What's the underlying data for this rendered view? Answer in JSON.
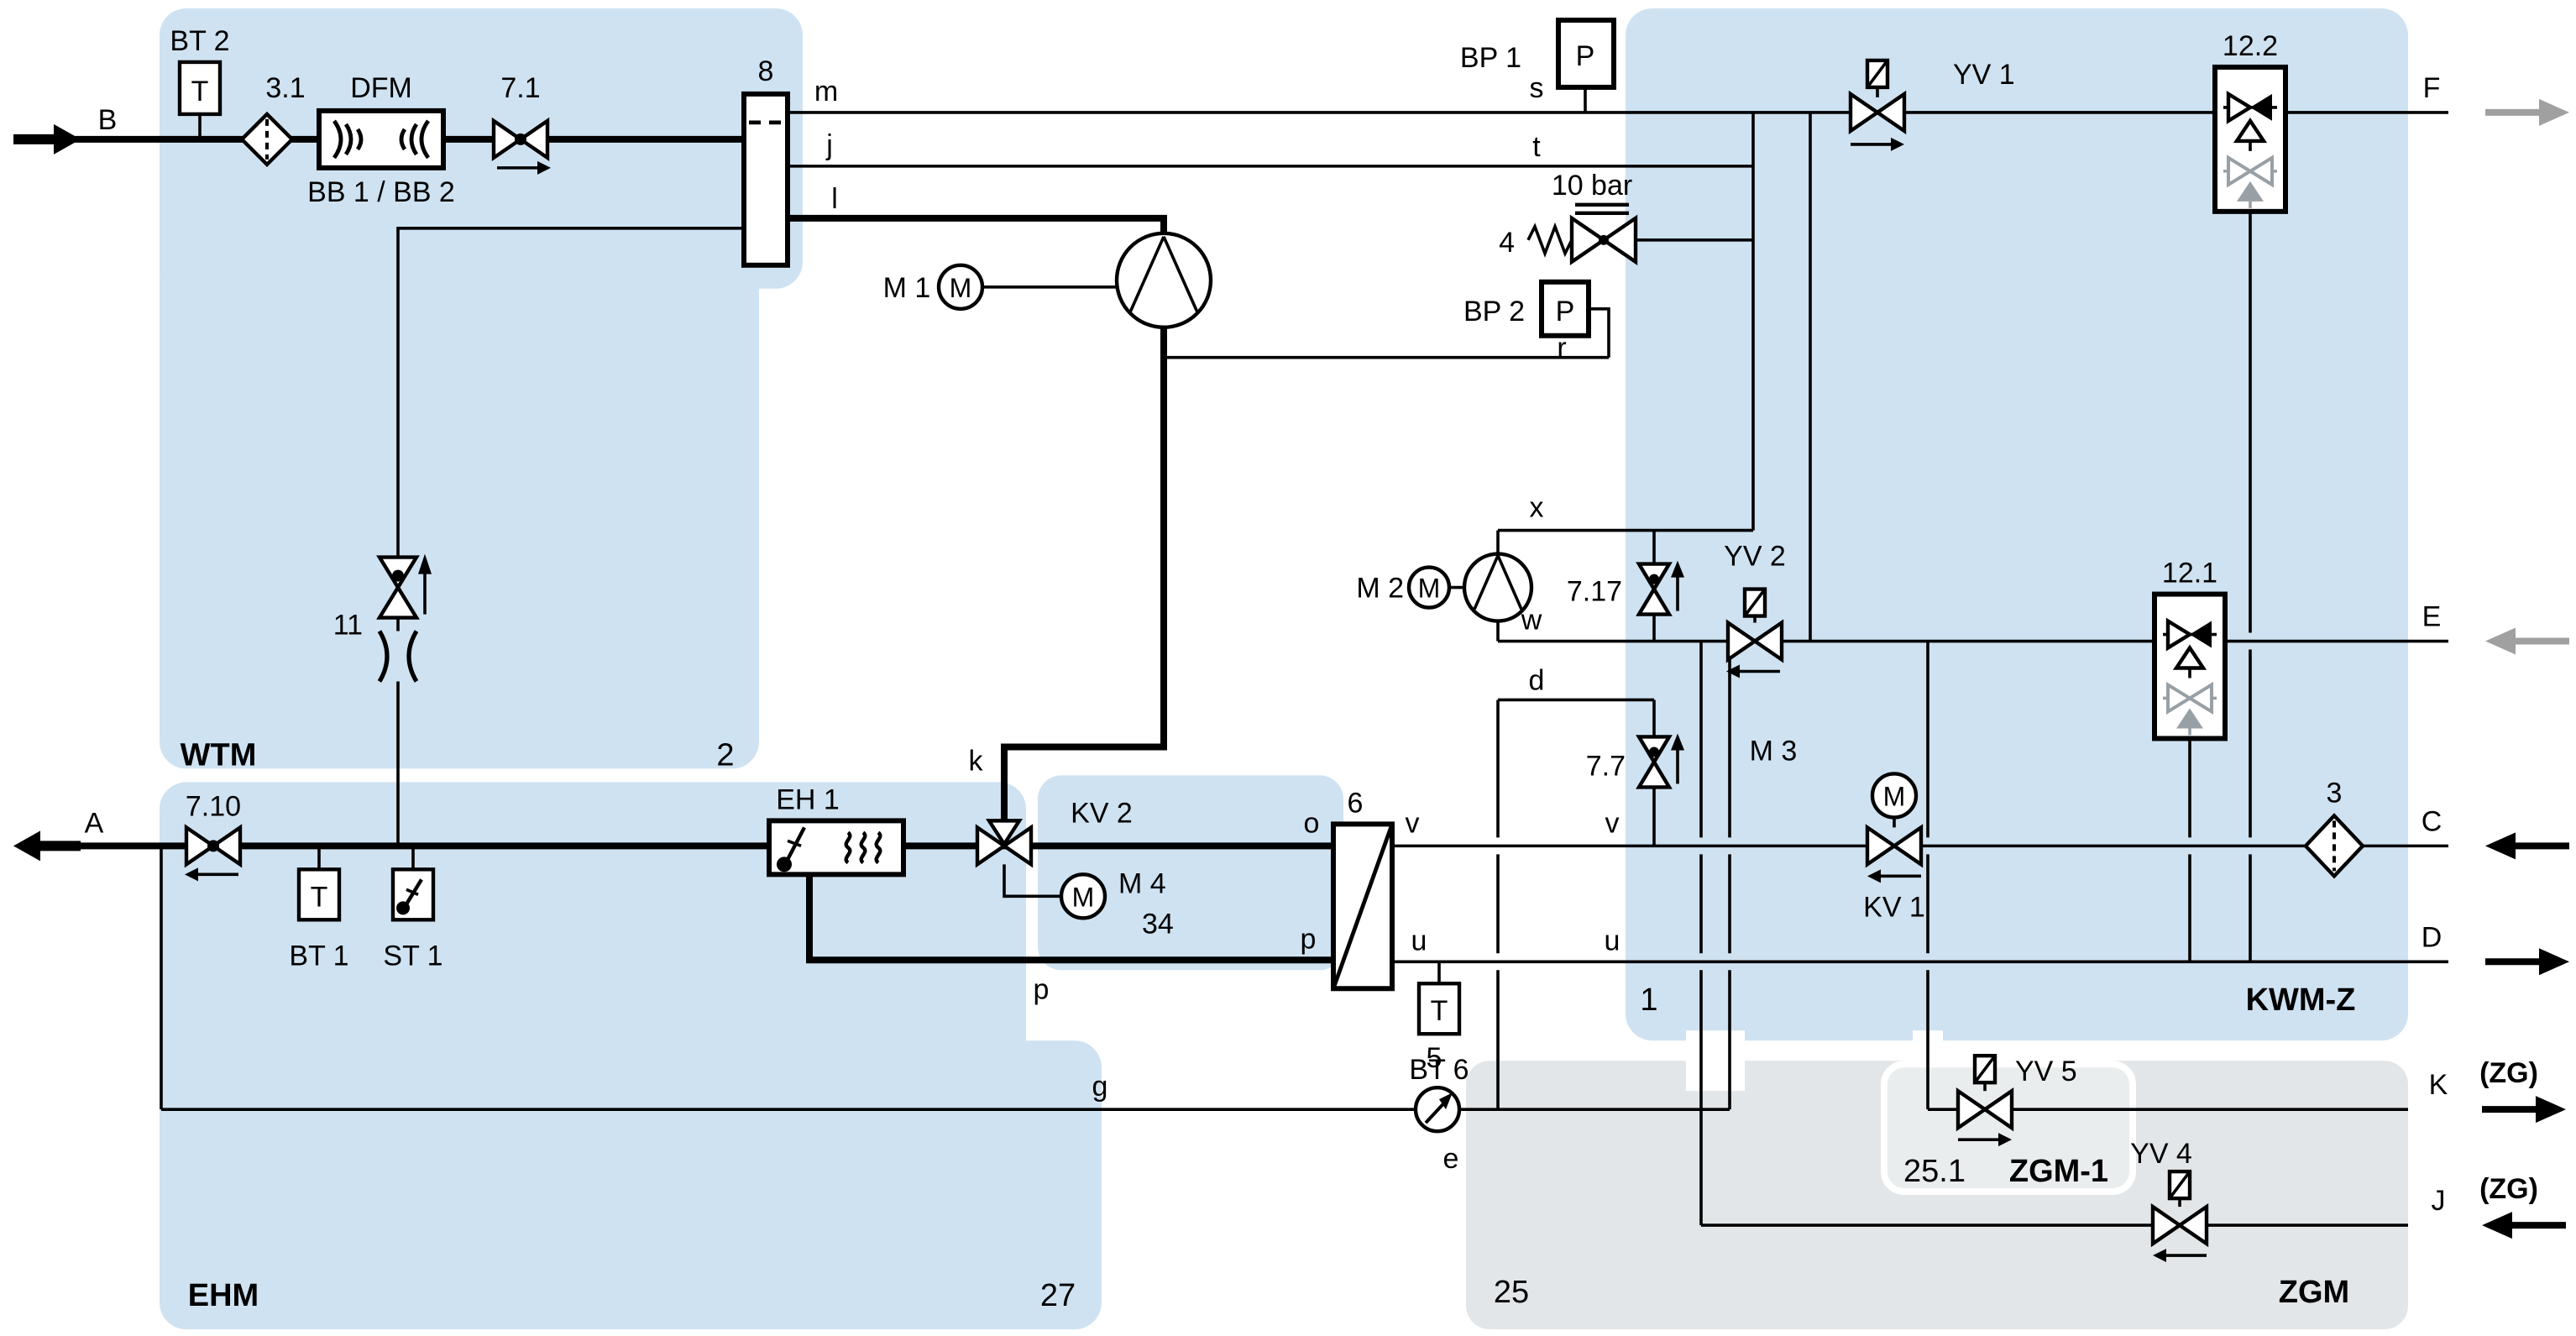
{
  "colors": {
    "zone_blue": "#cfe2f1",
    "zone_gray": "#e3e6e8",
    "zone_gray_light": "#eaedee",
    "pipe": "#000000",
    "gray_arrow": "#a0a0a0",
    "gray_check": "#98a0a6"
  },
  "z": {
    "wtm": "WTM",
    "wtm_n": "2",
    "ehm": "EHM",
    "ehm_n": "27",
    "kwmz": "KWM-Z",
    "kwmz_n": "1",
    "zgm": "ZGM",
    "zgm_n": "25",
    "zgm1": "ZGM-1",
    "zgm1_n": "25.1",
    "kv2": "KV 2"
  },
  "term": {
    "a": "A",
    "b": "B",
    "c": "C",
    "d": "D",
    "e": "E",
    "f": "F",
    "k": "K",
    "j": "J",
    "zg1": "(ZG)",
    "zg2": "(ZG)"
  },
  "port": {
    "m": "m",
    "j": "j",
    "l": "l",
    "s": "s",
    "t": "t",
    "r": "r",
    "x": "x",
    "w": "w",
    "d": "d",
    "v1": "v",
    "v2": "v",
    "u1": "u",
    "u2": "u",
    "o": "o",
    "p1": "p",
    "p2": "p",
    "k": "k",
    "g": "g",
    "e": "e"
  },
  "comp": {
    "bt2": "BT 2",
    "bt1": "BT 1",
    "bt6": "BT 6",
    "st1": "ST 1",
    "bp1": "BP 1",
    "bp2": "BP 2",
    "t1": "T",
    "t2": "T",
    "t3": "T",
    "p1": "P",
    "p2": "P",
    "mm1": "M",
    "mm2": "M",
    "mm3": "M",
    "mm4": "M",
    "f31": "3.1",
    "dfm": "DFM",
    "bb": "BB 1 / BB 2",
    "v71": "7.1",
    "n8": "8",
    "m1": "M 1",
    "m2": "M 2",
    "m3": "M 3",
    "m4": "M 4",
    "n34": "34",
    "tenbar": "10 bar",
    "n4": "4",
    "yv1": "YV 1",
    "yv2": "YV 2",
    "yv4": "YV 4",
    "yv5": "YV 5",
    "c122": "12.2",
    "c121": "12.1",
    "n11": "11",
    "v710": "7.10",
    "v717": "7.17",
    "v77": "7.7",
    "kv1": "KV 1",
    "eh1": "EH 1",
    "n6": "6",
    "n3": "3",
    "n5": "5"
  }
}
